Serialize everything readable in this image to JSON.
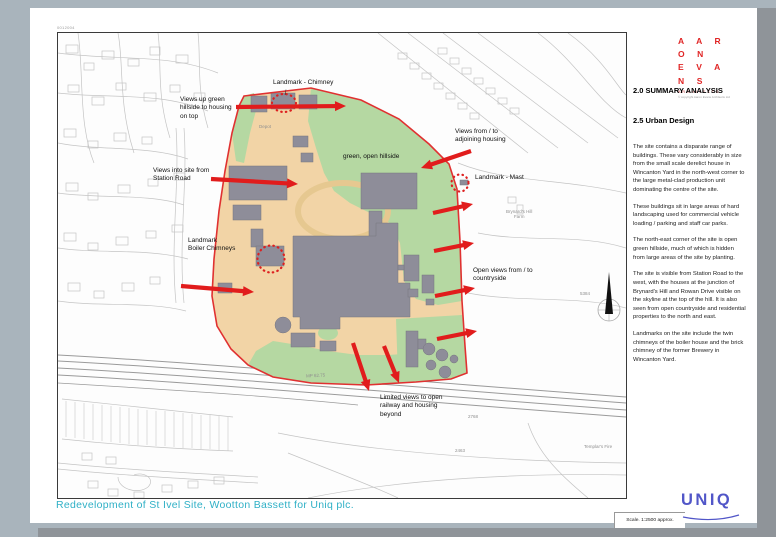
{
  "page": {
    "sheet_ref": "0012004",
    "footer_title": "Redevelopment of  St Ivel Site, Wootton Bassett for Uniq plc.",
    "uniq_logo": "UNIQ"
  },
  "architect_logo": {
    "line1": "A A R O N",
    "line2": "E V A N S",
    "line3": "ARCHITECTS",
    "copyright": "© copyright Aaron Evans Architects Ltd"
  },
  "analysis": {
    "section_title": "2.0  SUMMARY ANALYSIS",
    "subsection_title": "2.5  Urban Design",
    "paragraphs": [
      "The site contains a disparate range of buildings. These vary considerably in size from the small scale derelict  house in Wincanton Yard in the north-west corner to the large metal-clad production unit dominating the centre of the site.",
      "These buildings sit in large areas of hard landscaping used for commercial vehicle loading / parking and staff car parks.",
      "The north-east corner of the site is open green hillside, much of which is hidden from large areas of the site by planting.",
      "The site is visible from Station Road to the west, with the houses at the junction of Brynard's Hill and Rowan Drive visible on the skyline at the top of the hill. It is also seen from  open countryside and residential properties to the north and east.",
      "Landmarks on the site include the twin chimneys of the boiler house and the brick chimney of the former Brewery in Wincanton Yard."
    ]
  },
  "map": {
    "labels": {
      "landmark_chimney": "Landmark - Chimney",
      "views_up": "Views up green\nhillside to housing\non top",
      "views_into": "Views into site from\nStation Road",
      "landmark_boiler": "Landmark\nBoiler Chimneys",
      "green_hillside": "green, open hillside",
      "views_adjoining": "Views from / to\nadjoining housing",
      "landmark_mast": "Landmark - Mast",
      "open_views": "Open views from / to\ncountryside",
      "limited_views": "Limited views to open\nrailway and housing\nbeyond",
      "scale": "Scale. 1:2500 approx."
    },
    "annotations": {
      "depot": "Depot",
      "brynards_farm": "Brynard's Hill\nFarm",
      "templars": "Templar's Fire",
      "n2768": "2768",
      "n2463": "2463",
      "n5384": "5384",
      "mp": "MP 62.75"
    },
    "colors": {
      "site_hardstanding": "#f2d4a6",
      "open_hillside": "#b5d8a2",
      "buildings": "#8e8d99",
      "view_arrows": "#e11c1c",
      "site_boundary": "#e03131"
    }
  }
}
